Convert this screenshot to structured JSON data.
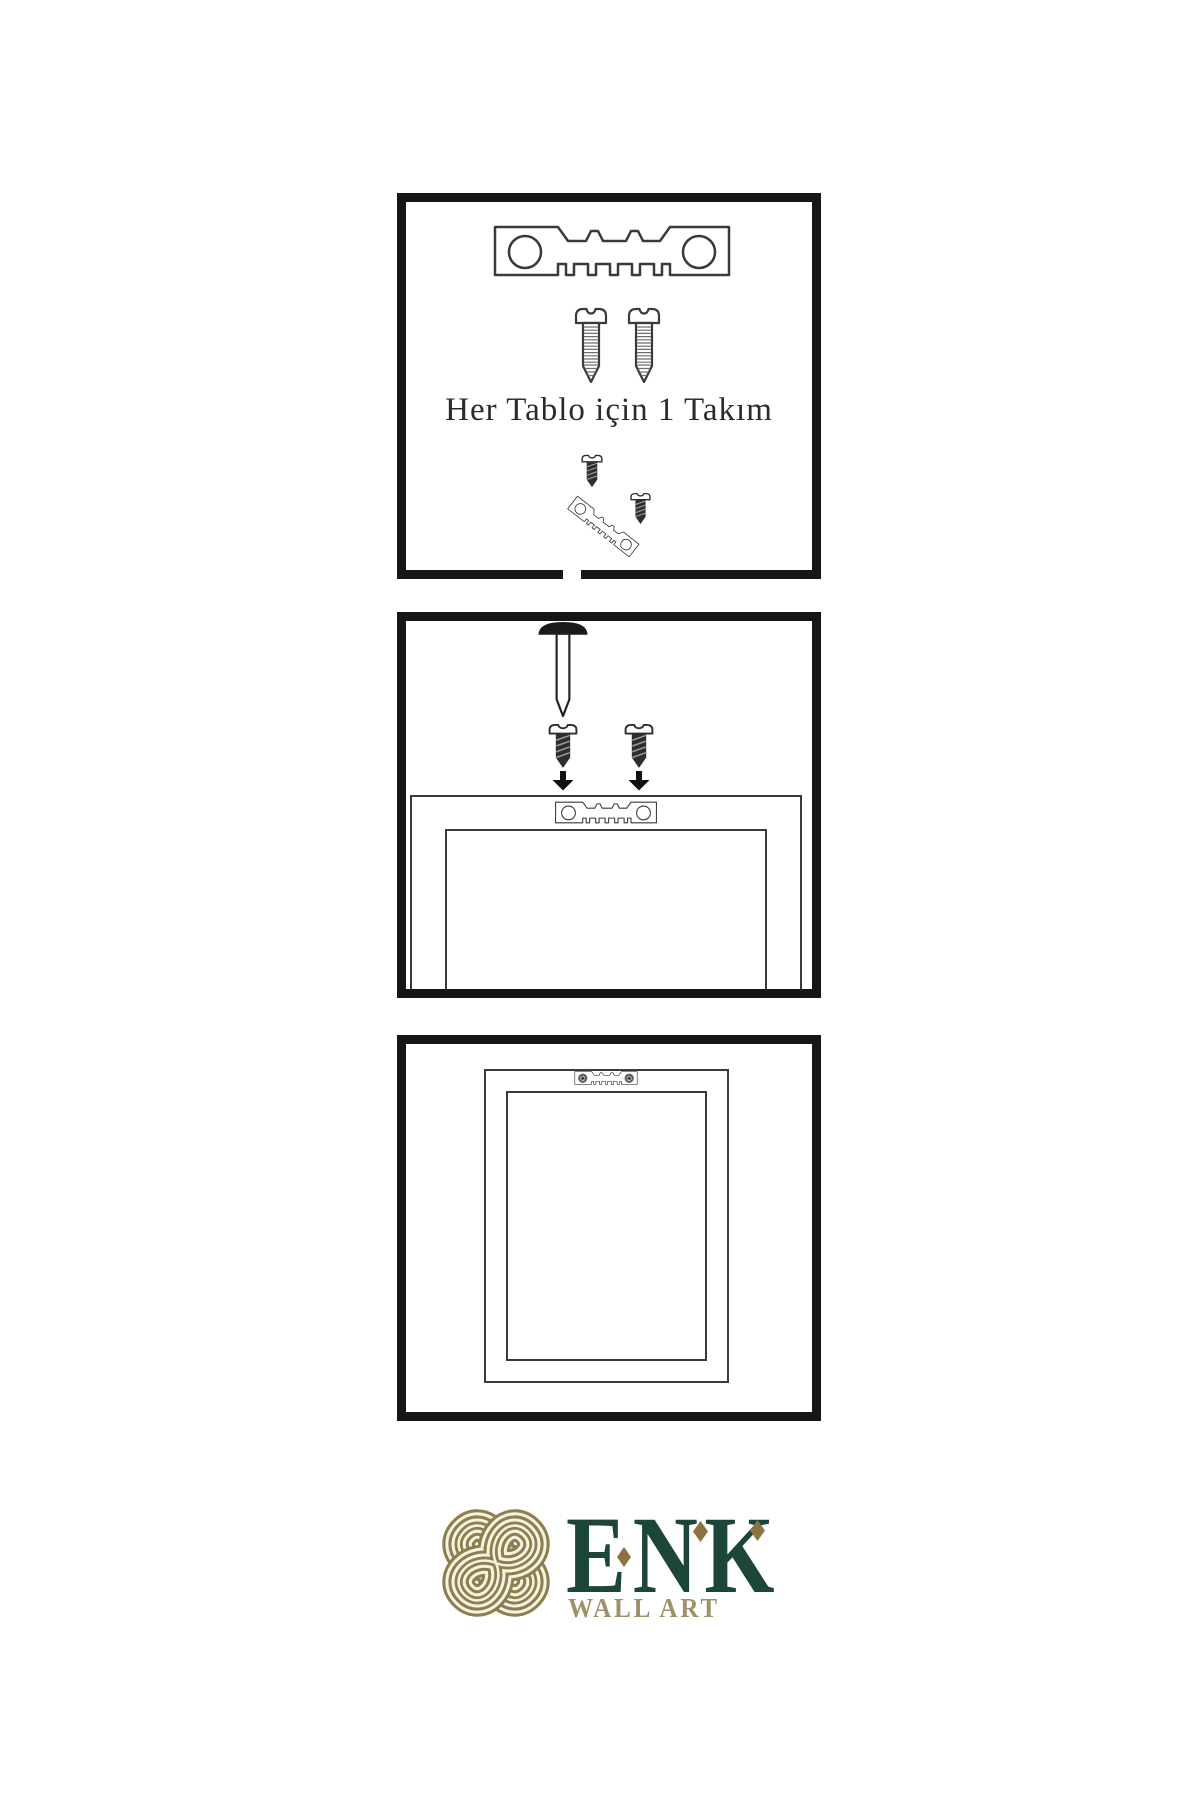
{
  "background": "#ffffff",
  "colors": {
    "panel_border": "#161616",
    "outline": "#3a3a3a",
    "dark_metal": "#2e2e2e",
    "caption_text": "#2b2b2b",
    "logo_green": "#1c4639",
    "logo_gold_knot": "#8c7e4d",
    "logo_gold_diamond": "#8c7340",
    "logo_tan": "#9e916a",
    "logo_cream": "#f6f1e2"
  },
  "panels": [
    {
      "name": "hardware-kit",
      "caption": "Her Tablo için 1 Takım",
      "items": [
        "sawtooth-hanger",
        "screw",
        "screw",
        "small-dark-screw",
        "angled-sawtooth-hanger",
        "small-dark-screw"
      ]
    },
    {
      "name": "install-on-frame",
      "items": [
        "wall-nail",
        "dark-screw",
        "dark-screw",
        "down-arrow",
        "down-arrow",
        "frame-back",
        "sawtooth-hanger"
      ]
    },
    {
      "name": "finished-frame-back",
      "items": [
        "frame-back",
        "sawtooth-hanger-with-screws"
      ]
    }
  ],
  "logo": {
    "brand": "ENK",
    "subtitle": "WALL ART"
  }
}
